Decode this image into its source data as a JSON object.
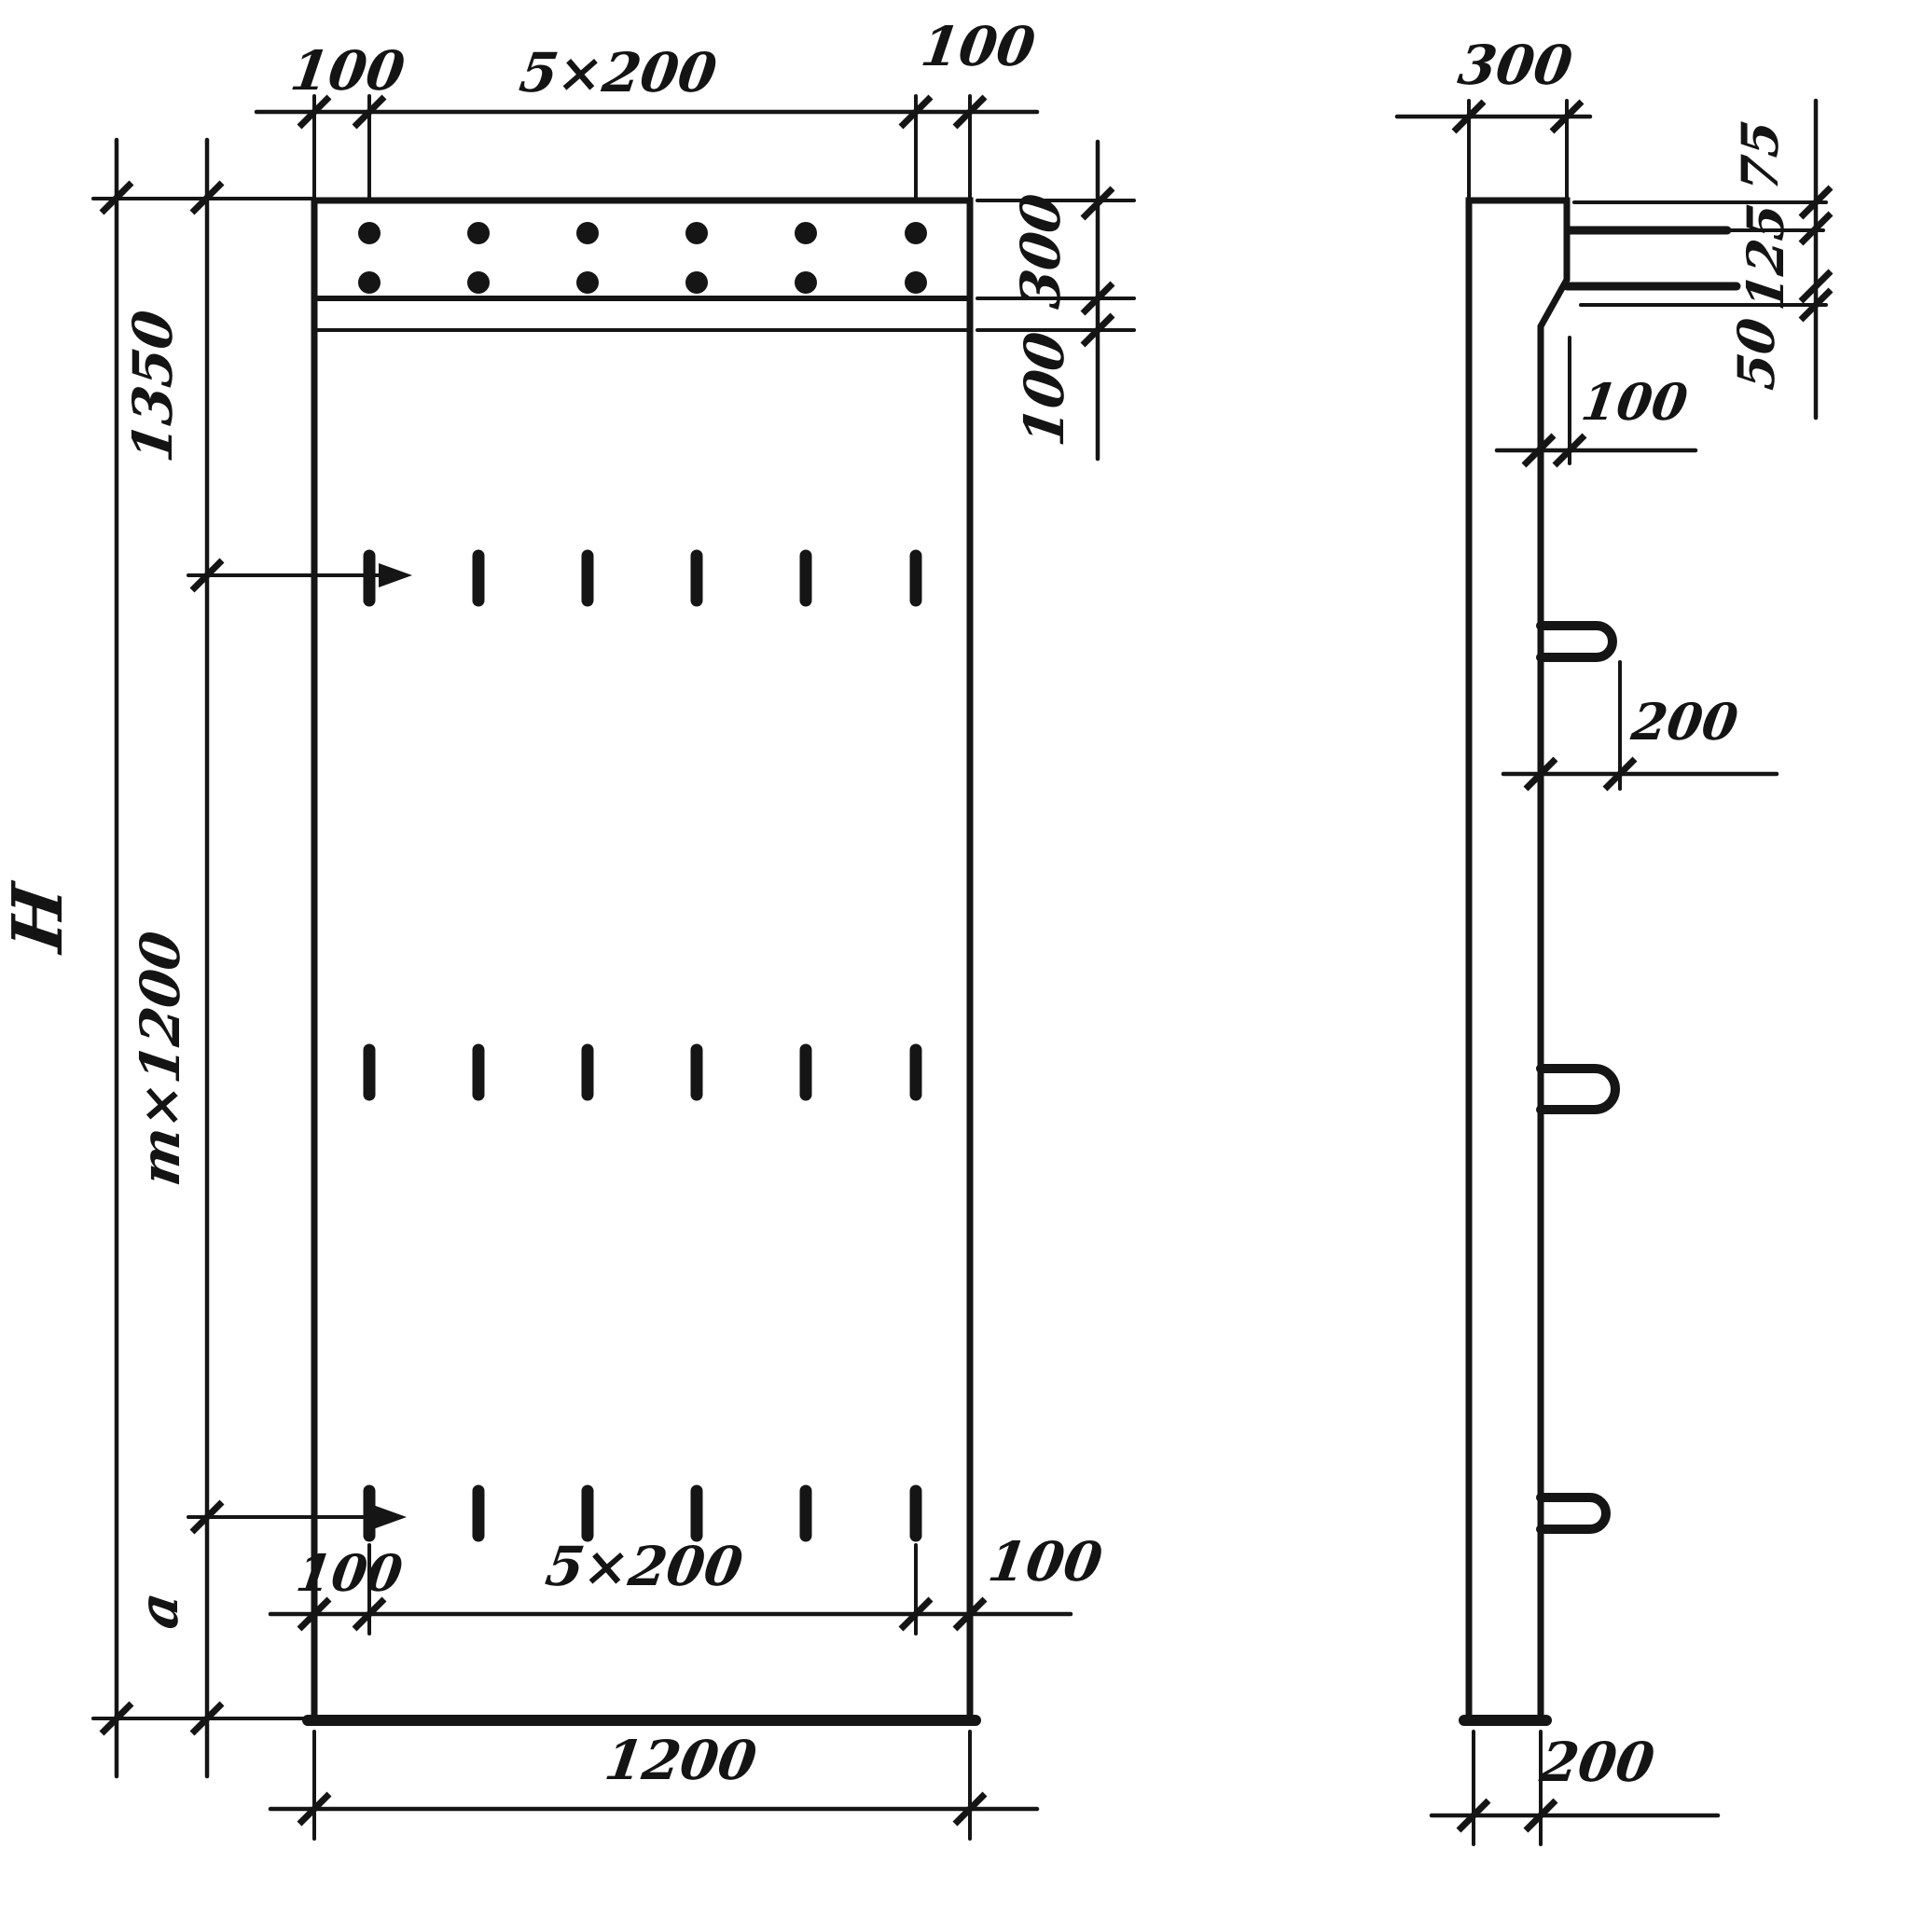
{
  "title": "Reinforced concrete panel shop drawing, front and side views",
  "front_view": {
    "top_dim": {
      "left": "100",
      "mid": "5×200",
      "right": "100"
    },
    "right_dim": {
      "strip": "300",
      "band": "100"
    },
    "left_dim": {
      "top": "1350",
      "middle": "m×1200",
      "bottom": "a",
      "overall": "H"
    },
    "bottom_dim": {
      "left": "100",
      "mid": "5×200",
      "right": "100",
      "overall": "1200"
    }
  },
  "side_view": {
    "top_dim": "300",
    "right_dim": {
      "upper": "75",
      "middle": "125",
      "lower": "50"
    },
    "bend_dim": "100",
    "loop_dim": "200",
    "bottom_dim": "200"
  },
  "colors": {
    "ink": "#151515",
    "paper": "#ffffff"
  }
}
